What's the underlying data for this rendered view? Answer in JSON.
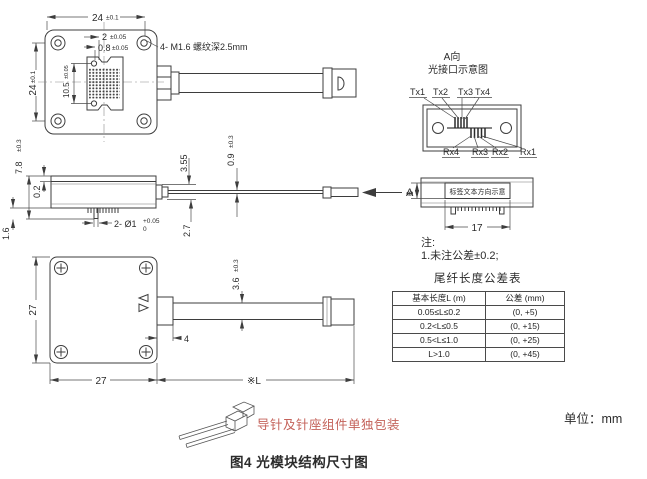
{
  "figure": {
    "caption": "图4 光模块结构尺寸图",
    "unit_label": "单位：mm",
    "packaging_note": "导针及针座组件单独包装"
  },
  "colors": {
    "line": "#3d3d3d",
    "packaging_red": "#c4625a"
  },
  "top_view": {
    "dim_width": {
      "v": "24",
      "t": "±0.1"
    },
    "dim_height": {
      "v": "24",
      "t": "±0.1"
    },
    "dim_port_a": {
      "v": "2",
      "t": "±0.05"
    },
    "dim_port_b": {
      "v": "0.8",
      "t": "±0.05"
    },
    "dim_port_h": {
      "v": "10.5",
      "t": "±0.05"
    },
    "thread_note": "4- M1.6 螺纹深2.5mm"
  },
  "side_view": {
    "dim_total_height": {
      "v": "7.8",
      "t": "±0.3"
    },
    "dim_lid": "0.2",
    "dim_pin_len": "1.6",
    "dim_pin": {
      "v": "2- Ø1",
      "upper": "+0.05",
      "lower": "0"
    },
    "dim_boot": "3.55",
    "dim_ferrule": "2.7",
    "dim_fiber": {
      "v": "0.9",
      "t": "±0.3"
    },
    "arrow_label": "A"
  },
  "interface_view": {
    "title1": "A向",
    "title2": "光接口示意图",
    "tx": [
      "Tx1",
      "Tx2",
      "Tx3",
      "Tx4"
    ],
    "rx": [
      "Rx4",
      "Rx3",
      "Rx2",
      "Rx1"
    ]
  },
  "label_view": {
    "label_text": "标签文本方向示意",
    "dim_h": "6",
    "dim_w": "17"
  },
  "bottom_view": {
    "dim_w": "27",
    "dim_h": "27",
    "dim_conn": "4",
    "dim_cable": {
      "v": "3.6",
      "t": "±0.3"
    },
    "dim_len": "※L"
  },
  "notes": {
    "title": "注:",
    "line1": "1.未注公差±0.2;"
  },
  "tolerance_table": {
    "title": "尾纤长度公差表",
    "headers": [
      "基本长度L (m)",
      "公差 (mm)"
    ],
    "rows": [
      [
        "0.05≤L≤0.2",
        "(0, +5)"
      ],
      [
        "0.2<L≤0.5",
        "(0, +15)"
      ],
      [
        "0.5<L≤1.0",
        "(0, +25)"
      ],
      [
        "L>1.0",
        "(0, +45)"
      ]
    ]
  }
}
